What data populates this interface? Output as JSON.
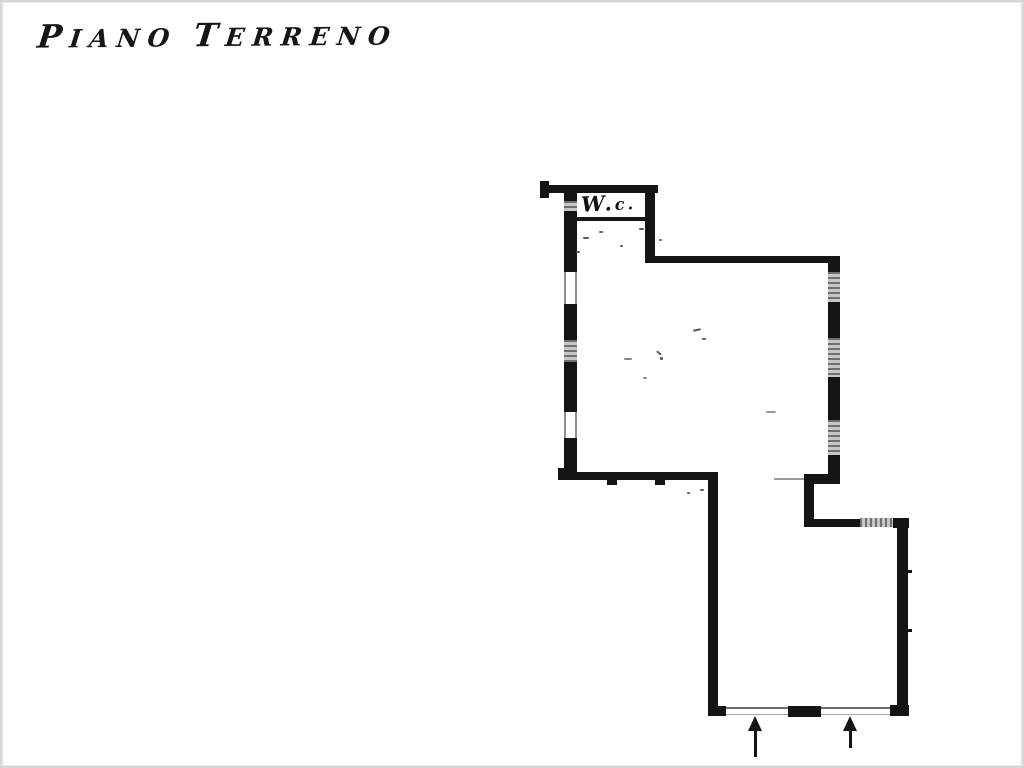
{
  "document": {
    "title": "Piano Terreno",
    "title_words": [
      "Piano",
      "Terreno"
    ]
  },
  "floor_plan": {
    "room_label": "W.c.",
    "entrance_arrow_count": 2,
    "colors": {
      "ink": "#141414",
      "hatch_fill": "#c6c6c6",
      "hatch_stripe": "#6f6f6f",
      "paper": "#ffffff",
      "scan_border": "#d8d8d8"
    }
  }
}
